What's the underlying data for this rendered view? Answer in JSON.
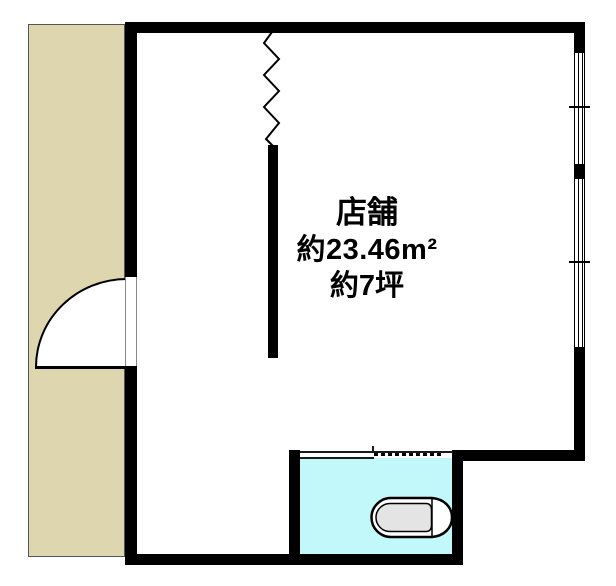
{
  "floorplan": {
    "room": {
      "name": "店舗",
      "area_sqm": "約23.46m²",
      "area_tsubo": "約7坪"
    },
    "colors": {
      "wall": "#000000",
      "common_area": "#ded6ae",
      "wc_floor": "#c2f8fa",
      "toilet_seat": "#e4e4e4"
    },
    "icons": {
      "toilet": "toilet-icon",
      "door": "door-swing-arc",
      "break_line": "zigzag-break-line-icon"
    }
  }
}
